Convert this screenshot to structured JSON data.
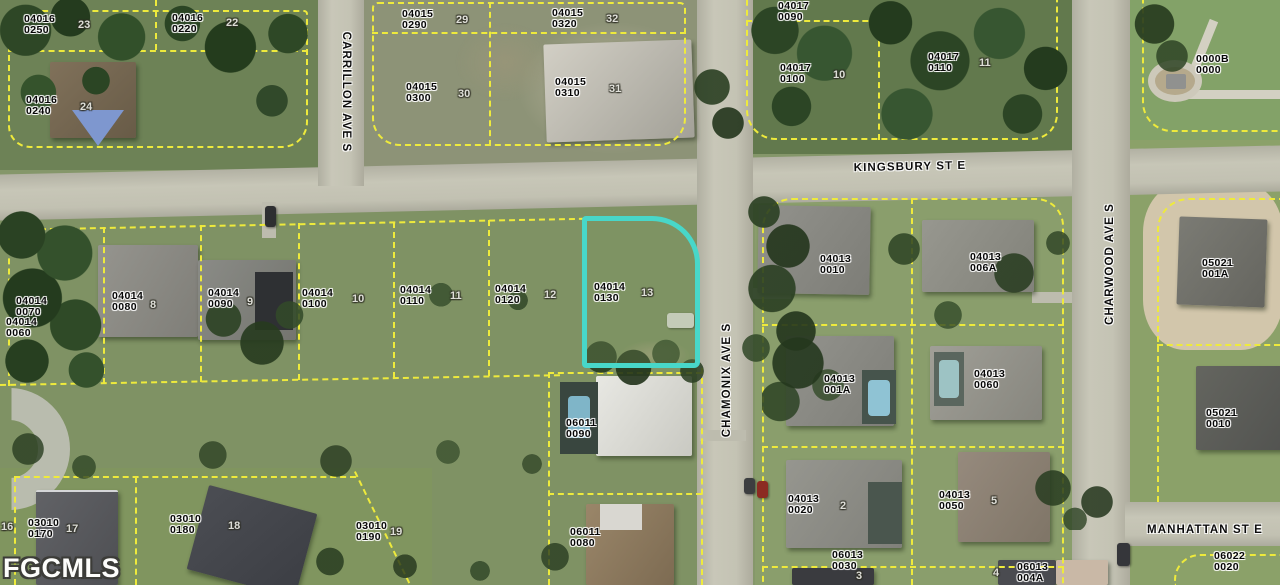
{
  "source_watermark": "FGCMLS",
  "highlighted_parcel": {
    "id": "04014 0130",
    "outline_color": "#48d7c9"
  },
  "streets": {
    "kingsbury": "KINGSBURY ST E",
    "carrillon": "CARRILLON AVE S",
    "chamonix": "CHAMONIX AVE S",
    "charwood": "CHARWOOD AVE S",
    "manhattan": "MANHATTAN ST E"
  },
  "map_colors": {
    "parcel_line": "#eeea3c",
    "highlight_outline": "#48d7c9",
    "road": "#bdbcae",
    "grass": "#85976a"
  },
  "parcels": [
    {
      "line1": "04016",
      "line2": "0250",
      "lot": "23"
    },
    {
      "line1": "04016",
      "line2": "0220",
      "lot": "22"
    },
    {
      "line1": "04016",
      "line2": "0240",
      "lot": "24"
    },
    {
      "line1": "04015",
      "line2": "0290",
      "lot": "29"
    },
    {
      "line1": "04015",
      "line2": "0320",
      "lot": "32"
    },
    {
      "line1": "04015",
      "line2": "0300",
      "lot": "30"
    },
    {
      "line1": "04015",
      "line2": "0310",
      "lot": "31"
    },
    {
      "line1": "04017",
      "line2": "0090"
    },
    {
      "line1": "04017",
      "line2": "0100",
      "lot": "10"
    },
    {
      "line1": "04017",
      "line2": "0110",
      "lot": "11"
    },
    {
      "line1": "0000B",
      "line2": "0000"
    },
    {
      "line1": "04014",
      "line2": "0070"
    },
    {
      "line1": "04014",
      "line2": "0060"
    },
    {
      "line1": "04014",
      "line2": "0080",
      "lot": "8"
    },
    {
      "line1": "04014",
      "line2": "0090",
      "lot": "9"
    },
    {
      "line1": "04014",
      "line2": "0100",
      "lot": "10"
    },
    {
      "line1": "04014",
      "line2": "0110",
      "lot": "11"
    },
    {
      "line1": "04014",
      "line2": "0120",
      "lot": "12"
    },
    {
      "line1": "04014",
      "line2": "0130",
      "lot": "13"
    },
    {
      "line1": "04013",
      "line2": "0010"
    },
    {
      "line1": "04013",
      "line2": "006A"
    },
    {
      "line1": "04013",
      "line2": "001A"
    },
    {
      "line1": "04013",
      "line2": "0060"
    },
    {
      "line1": "05021",
      "line2": "001A"
    },
    {
      "line1": "05021",
      "line2": "0010"
    },
    {
      "line1": "06011",
      "line2": "0090"
    },
    {
      "line1": "06011",
      "line2": "0080"
    },
    {
      "line1": "04013",
      "line2": "0020",
      "lot": "2"
    },
    {
      "line1": "04013",
      "line2": "0050",
      "lot": "5"
    },
    {
      "line1": "06013",
      "line2": "0030",
      "lot": "3"
    },
    {
      "line1": "06013",
      "line2": "004A",
      "lot": "4"
    },
    {
      "line1": "06022",
      "line2": "0020"
    },
    {
      "line1": "03010",
      "line2": "0170",
      "lot": "17"
    },
    {
      "line1": "03010",
      "line2": "0180",
      "lot": "18"
    },
    {
      "line1": "03010",
      "line2": "0190",
      "lot": "19"
    },
    {
      "lot": "16"
    }
  ]
}
